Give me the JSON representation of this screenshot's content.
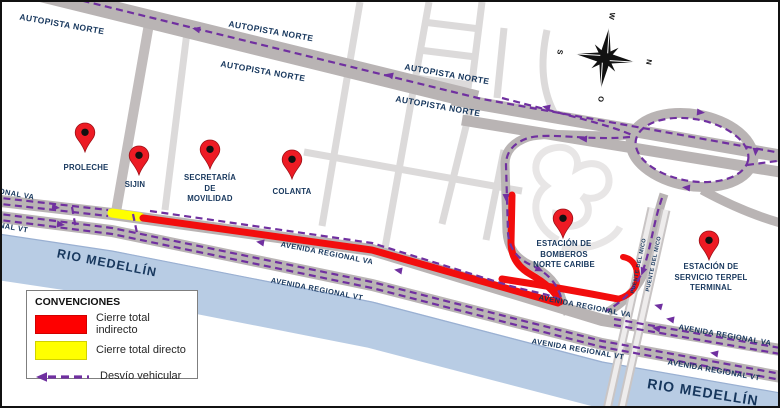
{
  "map": {
    "labels": [
      {
        "kind": "road",
        "text": "AUTOPISTA NORTE",
        "x": 60,
        "y": 22,
        "rot": 10,
        "size": 8.5
      },
      {
        "kind": "road",
        "text": "AUTOPISTA NORTE",
        "x": 269,
        "y": 29,
        "rot": 10,
        "size": 8.5
      },
      {
        "kind": "road",
        "text": "AUTOPISTA NORTE",
        "x": 261,
        "y": 69,
        "rot": 10,
        "size": 8.5
      },
      {
        "kind": "road",
        "text": "AUTOPISTA NORTE",
        "x": 445,
        "y": 72,
        "rot": 10,
        "size": 8.5
      },
      {
        "kind": "road",
        "text": "AUTOPISTA NORTE",
        "x": 436,
        "y": 104,
        "rot": 10,
        "size": 8.5
      },
      {
        "kind": "road",
        "text": "AVENIDA REGIONAL VA",
        "x": -14,
        "y": 187,
        "rot": 10,
        "size": 7.5
      },
      {
        "kind": "road",
        "text": "AVENIDA REGIONAL VT",
        "x": -20,
        "y": 220,
        "rot": 10,
        "size": 7.5
      },
      {
        "kind": "road",
        "text": "AVENIDA REGIONAL VA",
        "x": 325,
        "y": 251,
        "rot": 11,
        "size": 7.5
      },
      {
        "kind": "road",
        "text": "AVENIDA REGIONAL VT",
        "x": 315,
        "y": 287,
        "rot": 11,
        "size": 7.5
      },
      {
        "kind": "road",
        "text": "AVENIDA REGIONAL VA",
        "x": 583,
        "y": 304,
        "rot": 11,
        "size": 7.5
      },
      {
        "kind": "road",
        "text": "AVENIDA REGIONAL VA",
        "x": 723,
        "y": 333,
        "rot": 10,
        "size": 7.5
      },
      {
        "kind": "road",
        "text": "AVENIDA REGIONAL VT",
        "x": 576,
        "y": 347,
        "rot": 10,
        "size": 7.5
      },
      {
        "kind": "road",
        "text": "AVENIDA REGIONAL VT",
        "x": 712,
        "y": 368,
        "rot": 10,
        "size": 7.5
      },
      {
        "kind": "river",
        "text": "RIO MEDELLÍN",
        "x": 105,
        "y": 261,
        "rot": 11,
        "size": 12.5
      },
      {
        "kind": "river",
        "text": "RIO MEDELLÍN",
        "x": 701,
        "y": 390,
        "rot": 9,
        "size": 14
      },
      {
        "kind": "bridge",
        "text": "PUENTE DEL MICO",
        "x": 637,
        "y": 264,
        "rot": -78,
        "size": 5.5
      },
      {
        "kind": "bridge",
        "text": "PUENTE DEL MICO",
        "x": 652,
        "y": 262,
        "rot": -78,
        "size": 5.5
      }
    ],
    "markers": [
      {
        "name": "proleche",
        "lines": [
          "PROLECHE"
        ],
        "pin": {
          "x": 83,
          "y": 150
        },
        "label": {
          "x": 84,
          "y": 161
        }
      },
      {
        "name": "sijin",
        "lines": [
          "SIJIN"
        ],
        "pin": {
          "x": 137,
          "y": 173
        },
        "label": {
          "x": 133,
          "y": 178
        }
      },
      {
        "name": "secretaria-de-movilidad",
        "lines": [
          "SECRETARÍA",
          "DE",
          "MOVILIDAD"
        ],
        "pin": {
          "x": 208,
          "y": 167
        },
        "label": {
          "x": 208,
          "y": 171
        }
      },
      {
        "name": "colanta",
        "lines": [
          "COLANTA"
        ],
        "pin": {
          "x": 290,
          "y": 177
        },
        "label": {
          "x": 290,
          "y": 185
        }
      },
      {
        "name": "estacion-de-bomberos-norte-caribe",
        "lines": [
          "ESTACIÓN DE",
          "BOMBEROS",
          "NORTE CARIBE"
        ],
        "pin": {
          "x": 561,
          "y": 236
        },
        "label": {
          "x": 562,
          "y": 237
        }
      },
      {
        "name": "estacion-de-servicio-terpel-terminal",
        "lines": [
          "ESTACIÓN DE",
          "SERVICIO TERPEL",
          "TERMINAL"
        ],
        "pin": {
          "x": 707,
          "y": 258
        },
        "label": {
          "x": 709,
          "y": 260
        }
      }
    ],
    "compass": {
      "points": [
        {
          "dir": "top",
          "letter": "W",
          "x": 610,
          "y": 14
        },
        {
          "dir": "right",
          "letter": "N",
          "x": 647,
          "y": 60
        },
        {
          "dir": "left",
          "letter": "S",
          "x": 558,
          "y": 50
        },
        {
          "dir": "bottom",
          "letter": "O",
          "x": 599,
          "y": 97
        }
      ]
    },
    "legend": {
      "title": "CONVENCIONES",
      "items": [
        {
          "type": "solid",
          "color": "#fe0000",
          "label": "Cierre total indirecto"
        },
        {
          "type": "solid",
          "color": "#ffff00",
          "label": "Cierre total directo"
        },
        {
          "type": "dashed",
          "color": "#7030a0",
          "label": "Desvío vehicular"
        }
      ]
    },
    "colors": {
      "closure_indirect": "#fe0000",
      "closure_direct": "#ffff00",
      "detour": "#7030a0",
      "label_navy": "#17375d",
      "river": "#b8cce4",
      "road_gray": "#b9b4b4"
    }
  }
}
